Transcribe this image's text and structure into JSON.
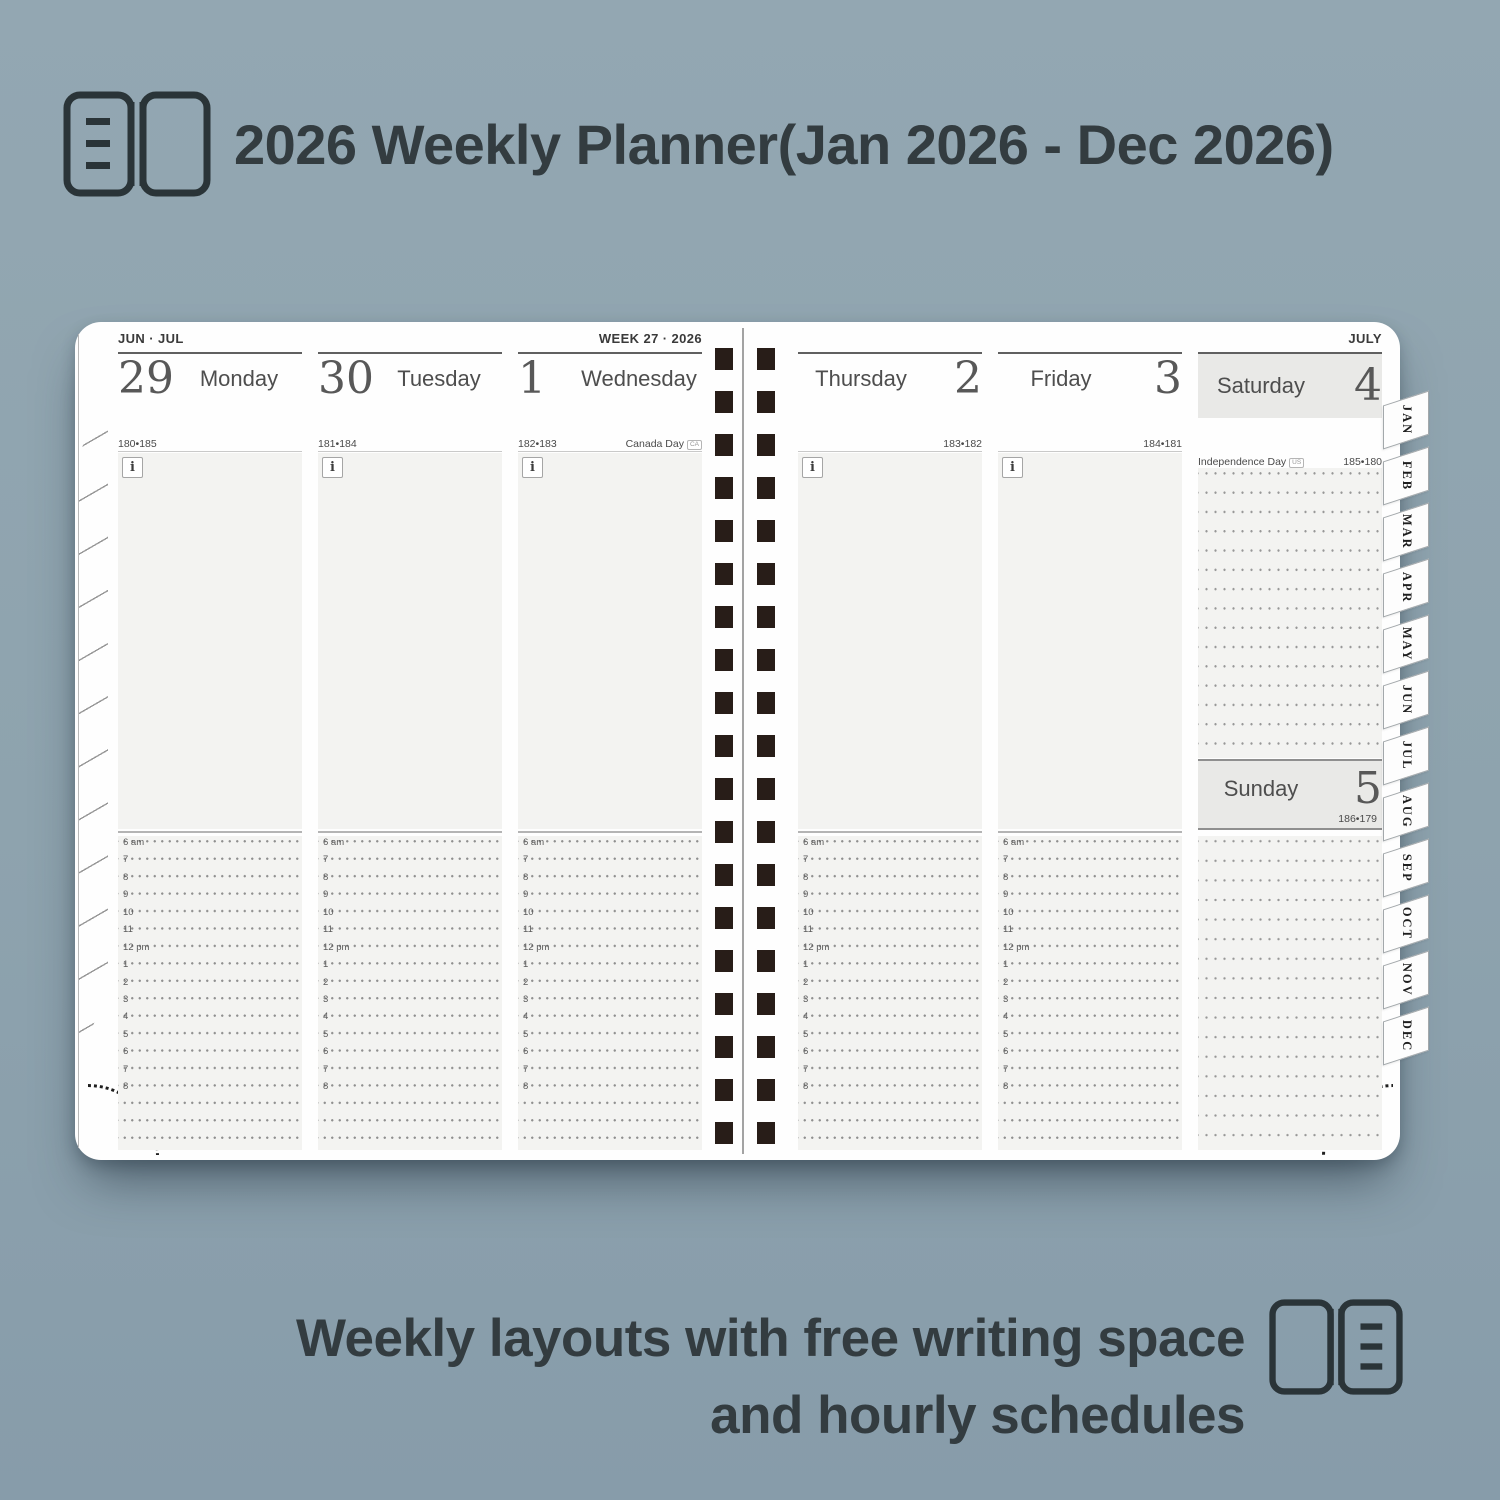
{
  "header": {
    "title": "2026 Weekly Planner(Jan 2026 - Dec 2026)"
  },
  "footer": {
    "line1": "Weekly layouts with free writing space",
    "line2": "and hourly schedules"
  },
  "colors": {
    "background": "#8fa4af",
    "title_text": "#333c40",
    "spiral": "#281d18",
    "weekend_box": "#e9e9e7",
    "area_gray": "#f3f3f1"
  },
  "planner": {
    "left_page_label": "JUN · JUL",
    "week_label": "WEEK 27 · 2026",
    "right_page_label": "JULY",
    "info_icon": "i",
    "month_tabs": [
      "JAN",
      "FEB",
      "MAR",
      "APR",
      "MAY",
      "JUN",
      "JUL",
      "AUG",
      "SEP",
      "OCT",
      "NOV",
      "DEC"
    ],
    "hours": [
      "6 am",
      "7",
      "8",
      "9",
      "10",
      "11",
      "12 pm",
      "1",
      "2",
      "3",
      "4",
      "5",
      "6",
      "7",
      "8"
    ],
    "days": {
      "monday": {
        "number": "29",
        "name": "Monday",
        "count": "180•185",
        "holiday": ""
      },
      "tuesday": {
        "number": "30",
        "name": "Tuesday",
        "count": "181•184",
        "holiday": ""
      },
      "wednesday": {
        "number": "1",
        "name": "Wednesday",
        "count": "182•183",
        "holiday": "Canada Day",
        "flag": "CA"
      },
      "thursday": {
        "number": "2",
        "name": "Thursday",
        "count": "183•182",
        "holiday": ""
      },
      "friday": {
        "number": "3",
        "name": "Friday",
        "count": "184•181",
        "holiday": ""
      },
      "saturday": {
        "number": "4",
        "name": "Saturday",
        "count": "185•180",
        "holiday": "Independence Day",
        "flag": "US"
      },
      "sunday": {
        "number": "5",
        "name": "Sunday",
        "count": "186•179"
      }
    }
  }
}
